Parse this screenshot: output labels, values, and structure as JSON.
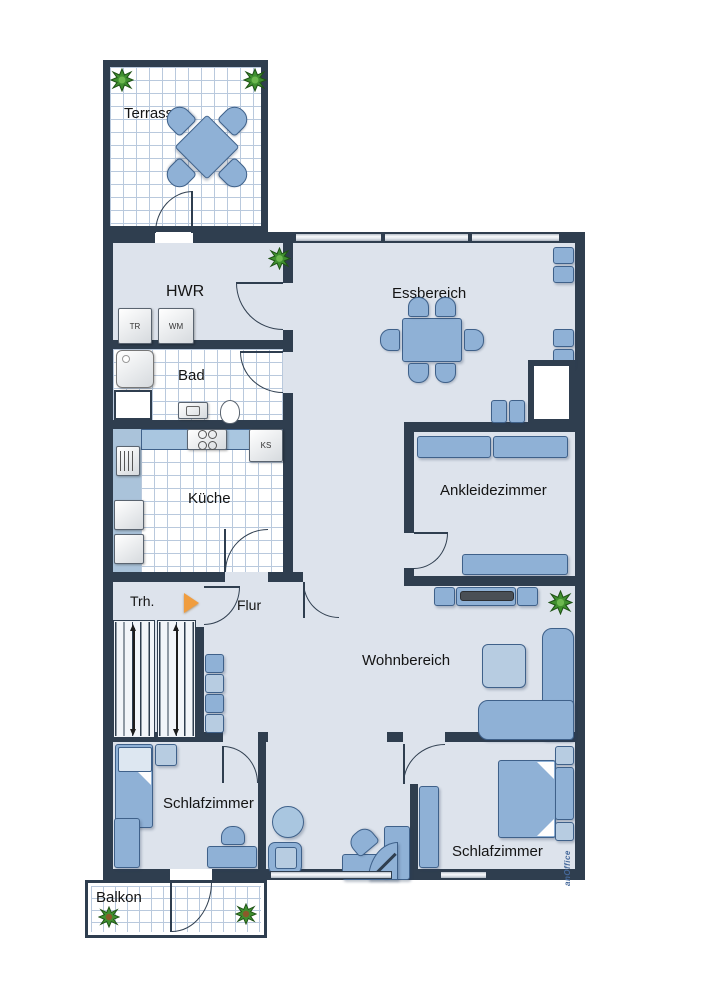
{
  "title": "Wohnung Grundriss",
  "rooms": {
    "terrasse": {
      "label": "Terrasse"
    },
    "hwr": {
      "label": "HWR"
    },
    "bad": {
      "label": "Bad"
    },
    "kueche": {
      "label": "Küche"
    },
    "essbereich": {
      "label": "Essbereich"
    },
    "ankleidezimmer": {
      "label": "Ankleidezimmer"
    },
    "treppenhaus": {
      "label": "Trh."
    },
    "flur": {
      "label": "Flur"
    },
    "wohnbereich": {
      "label": "Wohnbereich"
    },
    "schlafzimmer_links": {
      "label": "Schlafzimmer"
    },
    "schlafzimmer_rechts": {
      "label": "Schlafzimmer"
    },
    "balkon": {
      "label": "Balkon"
    }
  },
  "appliances": {
    "dryer": "TR",
    "washer": "WM",
    "fridge": "KS"
  },
  "watermark": "anOffice",
  "colors": {
    "wall": "#2f3e4f",
    "floor": "#dde3ec",
    "furniture": "#8fb1d6",
    "tile_line": "#b9c9dd",
    "entrance_arrow": "#f09d3f",
    "plant": "#3f8f2f"
  }
}
